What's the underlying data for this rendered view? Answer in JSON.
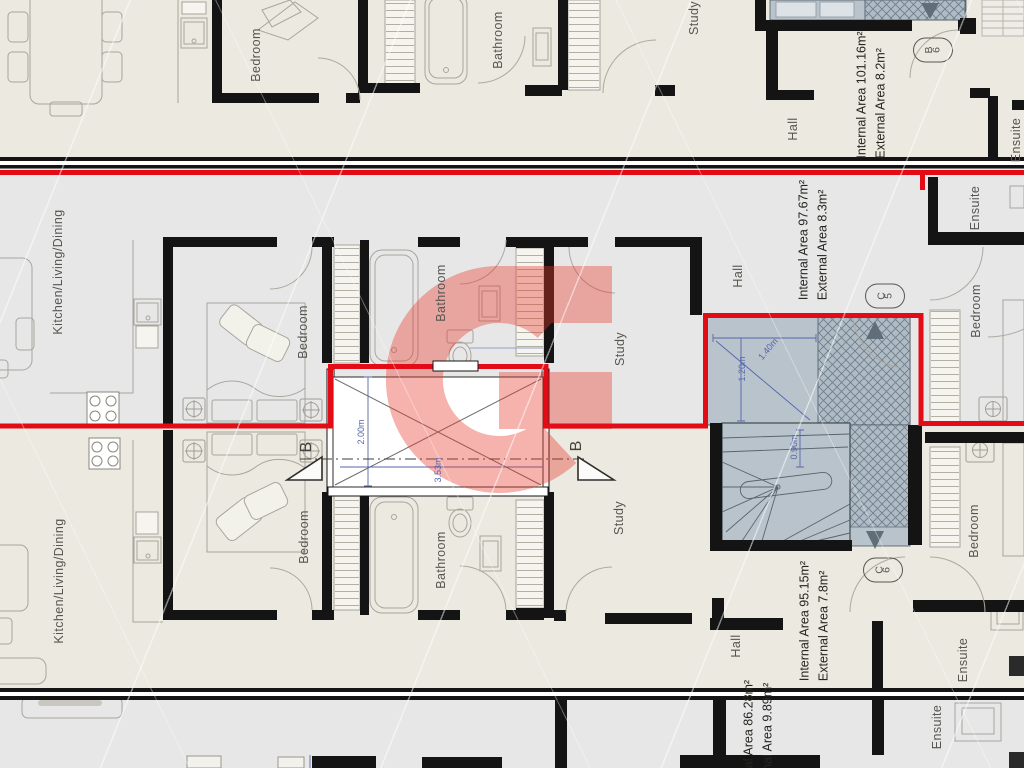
{
  "document": {
    "type": "architectural-floor-plan",
    "watermark_letter": "G"
  },
  "colors": {
    "bg_beige": "#ebe9e0",
    "bg_gray": "#e8e7e8",
    "wall_black": "#141414",
    "unit_boundary_red": "#e30b16",
    "watermark_red": "#e8392a",
    "stair_fill": "#b9c3cb",
    "stair_hatch": "#b0bcc5",
    "dimension_blue": "#5565ae"
  },
  "labels": {
    "rooms": [
      {
        "n": "room-label-bedroom-top",
        "t": "Bedroom",
        "x": 256,
        "y": 55
      },
      {
        "n": "room-label-bathroom-top",
        "t": "Bathroom",
        "x": 498,
        "y": 40
      },
      {
        "n": "room-label-study-top",
        "t": "Study",
        "x": 694,
        "y": 18
      },
      {
        "n": "room-label-hall-top",
        "t": "Hall",
        "x": 793,
        "y": 129
      },
      {
        "n": "room-label-ensuite-top",
        "t": "Ensuite",
        "x": 1016,
        "y": 140
      },
      {
        "n": "room-label-kitchen-living-dining-mid",
        "t": "Kitchen/Living/Dining",
        "x": 58,
        "y": 272
      },
      {
        "n": "room-label-bedroom-mid",
        "t": "Bedroom",
        "x": 303,
        "y": 332
      },
      {
        "n": "room-label-bathroom-mid",
        "t": "Bathroom",
        "x": 441,
        "y": 293
      },
      {
        "n": "room-label-study-mid",
        "t": "Study",
        "x": 620,
        "y": 349
      },
      {
        "n": "room-label-hall-mid",
        "t": "Hall",
        "x": 738,
        "y": 276
      },
      {
        "n": "room-label-ensuite-mid",
        "t": "Ensuite",
        "x": 975,
        "y": 208
      },
      {
        "n": "room-label-bedroom-mid-right",
        "t": "Bedroom",
        "x": 976,
        "y": 311
      },
      {
        "n": "room-label-kitchen-living-dining-low",
        "t": "Kitchen/Living/Dining",
        "x": 59,
        "y": 581
      },
      {
        "n": "room-label-bedroom-low",
        "t": "Bedroom",
        "x": 304,
        "y": 537
      },
      {
        "n": "room-label-bathroom-low",
        "t": "Bathroom",
        "x": 441,
        "y": 560
      },
      {
        "n": "room-label-study-low",
        "t": "Study",
        "x": 619,
        "y": 518
      },
      {
        "n": "room-label-hall-low",
        "t": "Hall",
        "x": 736,
        "y": 646
      },
      {
        "n": "room-label-bedroom-low-right",
        "t": "Bedroom",
        "x": 974,
        "y": 531
      },
      {
        "n": "room-label-ensuite-low",
        "t": "Ensuite",
        "x": 963,
        "y": 660
      },
      {
        "n": "room-label-ensuite-bottom",
        "t": "Ensuite",
        "x": 937,
        "y": 727
      }
    ],
    "areas": [
      {
        "n": "area-label-unit-b6",
        "x": 871,
        "y": 95,
        "lines": [
          "Internal Area 101.16m²",
          "External Area 8.2m²"
        ]
      },
      {
        "n": "area-label-unit-c5",
        "x": 813,
        "y": 240,
        "lines": [
          "Internal Area 97.67m²",
          "External Area 8.3m²"
        ]
      },
      {
        "n": "area-label-unit-c6",
        "x": 814,
        "y": 621,
        "lines": [
          "Internal Area 95.15m²",
          "External Area 7.8m²"
        ]
      },
      {
        "n": "area-label-unit-bottom",
        "x": 758,
        "y": 740,
        "lines": [
          "Internal Area 86.28m²",
          "External Area 9.89m²"
        ]
      }
    ],
    "dimensions": [
      {
        "n": "dim-2-00m",
        "t": "2.00m",
        "x": 361,
        "y": 432,
        "r": -90
      },
      {
        "n": "dim-3-53m",
        "t": "3.53m",
        "x": 438,
        "y": 470,
        "r": -90
      },
      {
        "n": "dim-1-20m",
        "t": "1.20m",
        "x": 742,
        "y": 369,
        "r": -90
      },
      {
        "n": "dim-1-40m",
        "t": "1.40m",
        "x": 768,
        "y": 349,
        "r": -50
      },
      {
        "n": "dim-0-90m",
        "t": "0.90m",
        "x": 794,
        "y": 447,
        "r": -90
      }
    ],
    "badges": [
      {
        "n": "unit-badge-b6",
        "t": "B6",
        "x": 933,
        "y": 50
      },
      {
        "n": "unit-badge-c5",
        "t": "C5",
        "x": 885,
        "y": 296
      },
      {
        "n": "unit-badge-c6",
        "t": "C6",
        "x": 883,
        "y": 570
      }
    ],
    "sections": [
      {
        "n": "section-marker-b-left",
        "t": "B",
        "x": 307,
        "y": 447
      },
      {
        "n": "section-marker-b-right",
        "t": "B",
        "x": 577,
        "y": 446
      }
    ]
  }
}
